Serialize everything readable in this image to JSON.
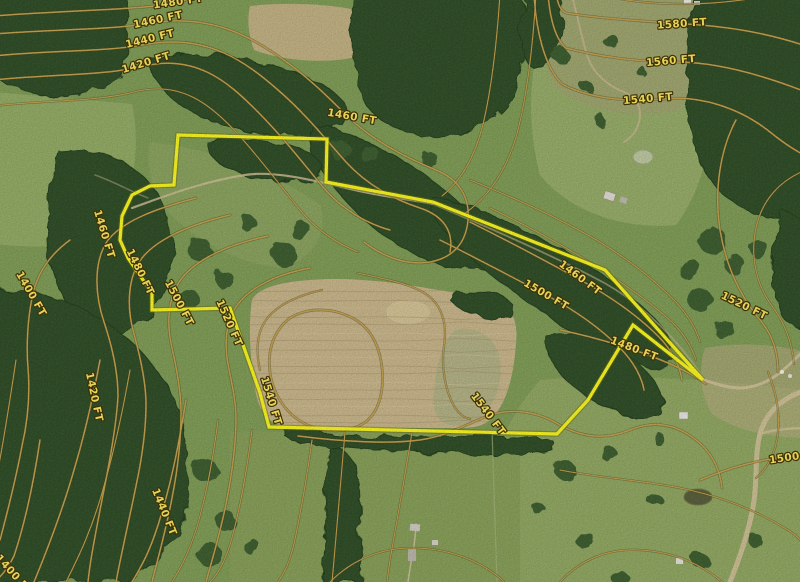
{
  "map": {
    "type": "satellite-topographic",
    "units": "FT",
    "contour_interval_ft": 20,
    "palette": {
      "boundary_yellow": "#f2ef1f",
      "boundary_casing": "#6b6b10",
      "contour_core": "#bd9c4c",
      "contour_casing": "#4a3c16",
      "label_fill": "#f5df5c",
      "label_outline": "#3e3205"
    },
    "elevation_labels": [
      {
        "text": "1480 FT",
        "x": 178,
        "y": 2,
        "rot": -8
      },
      {
        "text": "1460 FT",
        "x": 158,
        "y": 20,
        "rot": -12
      },
      {
        "text": "1440 FT",
        "x": 150,
        "y": 39,
        "rot": -14
      },
      {
        "text": "1420 FT",
        "x": 146,
        "y": 63,
        "rot": -17
      },
      {
        "text": "1460 FT",
        "x": 352,
        "y": 117,
        "rot": 10
      },
      {
        "text": "1580 FT",
        "x": 682,
        "y": 24,
        "rot": -4
      },
      {
        "text": "1560 FT",
        "x": 671,
        "y": 61,
        "rot": -5
      },
      {
        "text": "1540 FT",
        "x": 648,
        "y": 99,
        "rot": -5
      },
      {
        "text": "1460 FT",
        "x": 104,
        "y": 234,
        "rot": 73
      },
      {
        "text": "1400 FT",
        "x": 31,
        "y": 294,
        "rot": 60
      },
      {
        "text": "1480 FT",
        "x": 140,
        "y": 272,
        "rot": 64
      },
      {
        "text": "1500 FT",
        "x": 179,
        "y": 303,
        "rot": 62
      },
      {
        "text": "1520 FT",
        "x": 229,
        "y": 323,
        "rot": 66
      },
      {
        "text": "1420 FT",
        "x": 94,
        "y": 397,
        "rot": 78
      },
      {
        "text": "1540 FT",
        "x": 271,
        "y": 401,
        "rot": 73
      },
      {
        "text": "1440 FT",
        "x": 164,
        "y": 512,
        "rot": 68
      },
      {
        "text": "1400 FT",
        "x": 14,
        "y": 575,
        "rot": 48
      },
      {
        "text": "1460 FT",
        "x": 580,
        "y": 278,
        "rot": 37
      },
      {
        "text": "1500 FT",
        "x": 546,
        "y": 295,
        "rot": 30
      },
      {
        "text": "1520 FT",
        "x": 744,
        "y": 306,
        "rot": 26
      },
      {
        "text": "1480 FT",
        "x": 634,
        "y": 349,
        "rot": 21
      },
      {
        "text": "1540 FT",
        "x": 488,
        "y": 414,
        "rot": 53
      },
      {
        "text": "1500 FT",
        "x": 794,
        "y": 457,
        "rot": -8
      }
    ],
    "boundary": {
      "color": "#f2ef1f",
      "points": [
        [
          178,
          135
        ],
        [
          327,
          139
        ],
        [
          326,
          182
        ],
        [
          433,
          202
        ],
        [
          605,
          270
        ],
        [
          703,
          380
        ],
        [
          633,
          325
        ],
        [
          588,
          400
        ],
        [
          557,
          434
        ],
        [
          269,
          427
        ],
        [
          260,
          393
        ],
        [
          230,
          308
        ],
        [
          152,
          310
        ],
        [
          152,
          292
        ],
        [
          143,
          280
        ],
        [
          128,
          258
        ],
        [
          120,
          240
        ],
        [
          122,
          216
        ],
        [
          132,
          195
        ],
        [
          150,
          186
        ],
        [
          174,
          185
        ]
      ]
    },
    "contours": [
      {
        "elev": "1480",
        "major": true,
        "d": "M -6 16 C 70 10 140 10 176 3 C 186 1 193 -3 198 -8"
      },
      {
        "elev": "1460",
        "major": true,
        "d": "M -6 34 C 56 29 112 30 152 23 C 214 13 258 40 292 66 C 322 89 340 110 356 124 C 382 146 412 160 436 170 C 458 179 470 196 468 220 C 466 244 452 258 430 262 C 406 266 382 256 364 242"
      },
      {
        "elev": "1440",
        "major": true,
        "d": "M -6 56 C 52 50 108 52 148 44 C 208 34 246 62 278 90 C 306 114 328 142 346 162 C 368 186 396 200 420 208 C 444 216 454 232 450 252"
      },
      {
        "elev": "1420",
        "major": true,
        "d": "M -6 80 C 48 74 104 76 144 66 C 196 54 228 82 256 110 C 282 136 304 164 322 186 C 342 210 368 224 390 230"
      },
      {
        "elev": null,
        "major": false,
        "d": "M -6 106 C 44 100 96 102 134 92 C 180 80 210 104 236 132 C 260 158 282 188 300 210 C 316 230 338 244 358 252"
      },
      {
        "elev": "1580",
        "major": true,
        "d": "M 556 -6 C 558 4 560 10 566 13 C 596 18 640 21 700 25 C 740 28 776 36 806 46"
      },
      {
        "elev": "1560",
        "major": true,
        "d": "M 548 -6 C 550 20 556 40 566 48 C 596 56 636 62 676 62 C 716 62 760 74 806 92"
      },
      {
        "elev": "1540",
        "major": true,
        "d": "M 534 -6 C 536 30 544 66 562 84 C 588 98 628 103 664 99 C 700 95 740 108 770 132 C 786 145 798 152 806 156"
      },
      {
        "elev": "1460",
        "major": true,
        "d": "M 196 198 C 158 208 124 220 108 240 C 94 260 94 292 104 322 C 112 346 118 372 118 396 C 116 430 108 470 100 510 C 94 542 90 562 88 582"
      },
      {
        "elev": "1400",
        "major": true,
        "d": "M 70 240 C 48 256 36 276 32 298 C 28 318 26 344 28 368 C 30 392 28 420 22 446 C 16 478 8 510 0 540"
      },
      {
        "elev": "1480",
        "major": true,
        "d": "M 230 215 C 192 224 158 238 142 258 C 128 276 126 306 134 334 C 140 356 146 382 146 404 C 146 430 142 458 136 486 C 130 516 122 550 116 582"
      },
      {
        "elev": "1500",
        "major": true,
        "d": "M 268 236 C 230 244 198 258 182 278 C 168 296 166 322 172 348 C 177 370 181 392 181 412 C 181 438 178 468 172 498 C 166 530 158 558 152 582"
      },
      {
        "elev": "1520",
        "major": true,
        "d": "M 310 268 C 278 274 252 286 238 304 C 226 320 224 342 228 364 C 232 384 236 402 236 418 C 236 444 232 474 226 504 C 220 534 212 560 206 582"
      },
      {
        "elev": "1420",
        "major": true,
        "d": "M 100 360 C 94 392 86 430 74 470 C 62 512 48 548 34 582"
      },
      {
        "elev": "1540",
        "major": true,
        "d": "M 290 318 C 310 306 336 308 356 320 C 372 330 380 348 382 368 C 384 390 380 408 368 420 C 354 432 330 434 310 426 C 290 418 276 400 271 378 C 266 354 272 332 290 318 Z"
      },
      {
        "elev": "1440",
        "major": true,
        "d": "M 186 400 C 180 436 174 472 162 512 C 150 554 140 568 132 582"
      },
      {
        "elev": "1400",
        "major": true,
        "d": "M 40 440 C 34 480 26 520 14 556 C 8 568 2 576 -6 582"
      },
      {
        "elev": "1460",
        "major": true,
        "d": "M 470 222 C 510 242 548 262 584 282 C 616 300 640 318 658 336 C 672 350 680 366 682 380"
      },
      {
        "elev": "1500",
        "major": true,
        "d": "M 440 240 C 480 260 514 278 548 296 C 578 312 602 330 620 348 C 634 362 642 378 644 390"
      },
      {
        "elev": "1520",
        "major": true,
        "d": "M 736 120 C 720 150 714 190 720 230 C 726 266 740 296 760 320 C 772 334 778 352 778 372"
      },
      {
        "elev": "1480",
        "major": true,
        "d": "M 560 330 C 590 336 616 344 640 352 C 668 362 690 372 706 384"
      },
      {
        "elev": "1540",
        "major": true,
        "d": "M 298 436 C 345 442 390 444 420 440 C 448 436 466 424 488 416 C 512 407 538 412 558 424 C 582 438 606 440 630 430 C 654 420 676 424 696 440 C 712 452 720 470 722 488"
      },
      {
        "elev": "1500",
        "major": true,
        "d": "M 700 480 C 724 470 750 462 776 458 C 788 456 798 456 806 456"
      },
      {
        "elev": null,
        "major": false,
        "d": "M 500 -6 C 497 40 492 85 484 120 C 476 155 462 180 442 196"
      },
      {
        "elev": null,
        "major": false,
        "d": "M 536 -6 C 533 45 528 90 518 130 C 508 168 490 196 464 214"
      },
      {
        "elev": null,
        "major": false,
        "d": "M 322 290 C 296 296 276 306 266 320 C 256 334 256 352 260 370"
      },
      {
        "elev": null,
        "major": false,
        "d": "M 357 273 C 392 280 418 286 431 298 C 443 309 447 326 444 346 C 441 366 445 390 454 406 C 459 414 464 418 470 419"
      },
      {
        "elev": null,
        "major": false,
        "d": "M 130 370 C 124 404 116 444 104 486 C 92 530 78 558 66 582"
      },
      {
        "elev": null,
        "major": false,
        "d": "M 218 420 C 214 452 208 490 196 530 C 186 560 178 572 172 582"
      },
      {
        "elev": null,
        "major": false,
        "d": "M 252 430 C 248 462 242 500 232 538 C 224 566 216 576 210 582"
      },
      {
        "elev": null,
        "major": false,
        "d": "M 312 440 C 308 470 302 506 294 544 C 288 568 282 576 278 582"
      },
      {
        "elev": null,
        "major": false,
        "d": "M 412 432 C 406 470 398 515 390 560 L 387 582"
      },
      {
        "elev": null,
        "major": false,
        "d": "M 345 432 C 342 470 338 515 334 560 L 332 582"
      },
      {
        "elev": null,
        "major": false,
        "d": "M 806 170 C 780 180 762 200 756 228 C 750 256 756 284 772 306 C 784 322 792 342 794 364"
      },
      {
        "elev": null,
        "major": false,
        "d": "M 490 208 C 528 226 564 246 596 266 C 626 285 652 304 672 322 C 684 334 692 348 696 360"
      },
      {
        "elev": null,
        "major": false,
        "d": "M 470 180 C 510 196 550 214 586 234 C 618 252 648 274 672 298 C 686 312 696 328 700 342"
      },
      {
        "elev": null,
        "major": false,
        "d": "M 560 470 C 600 478 640 480 680 488 C 720 496 756 510 788 530 C 798 536 804 544 806 548"
      },
      {
        "elev": null,
        "major": false,
        "d": "M 330 582 C 352 560 380 548 412 548 C 448 548 478 560 500 578 L 504 582"
      },
      {
        "elev": null,
        "major": false,
        "d": "M 560 582 C 580 560 608 548 640 550 C 676 552 704 566 722 582"
      },
      {
        "elev": null,
        "major": false,
        "d": "M 598 -6 C 620 0 650 4 684 4 C 716 4 748 0 778 -6"
      },
      {
        "elev": null,
        "major": false,
        "d": "M 768 372 C 776 392 780 412 778 432 C 776 452 768 468 756 478"
      },
      {
        "elev": null,
        "major": false,
        "d": "M 16 360 C 10 400 4 440 -4 480"
      }
    ]
  }
}
